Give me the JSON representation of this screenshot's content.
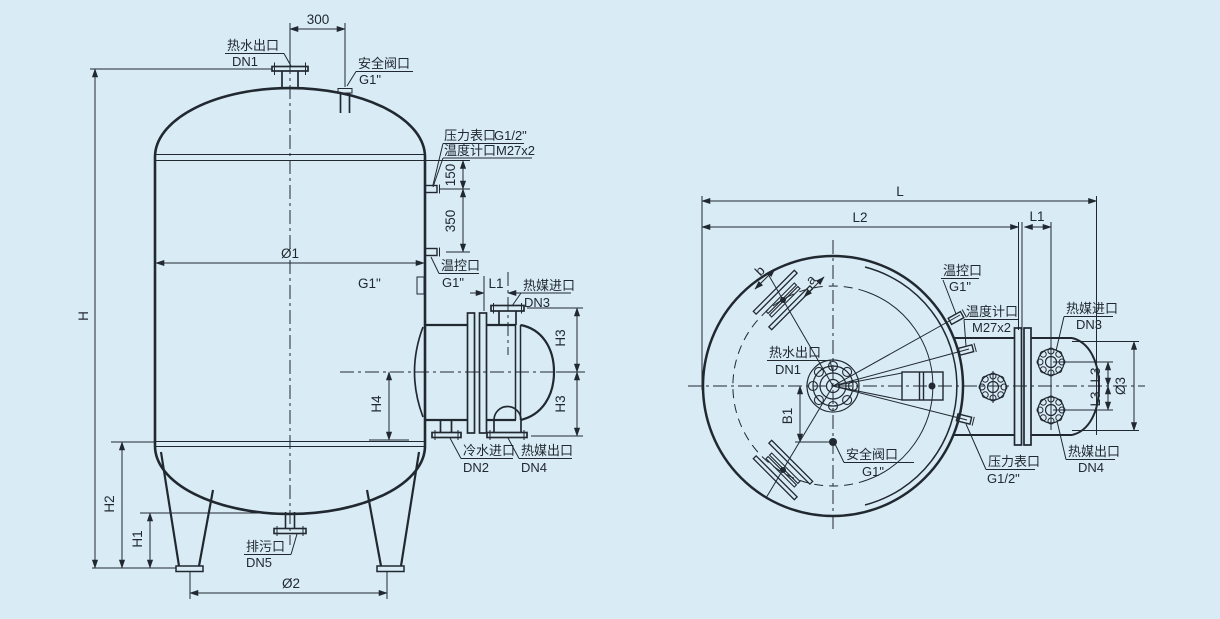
{
  "drawing_type": "pressure-vessel-engineering-drawing",
  "colors": {
    "background": "#d9ecf6",
    "line": "#212830"
  },
  "front": {
    "d300": "300",
    "d150": "150",
    "d350": "350",
    "hot_water": "热水出口",
    "hot_water_size": "DN1",
    "safety": "安全阀口",
    "safety_size": "G1\"",
    "pressure": "压力表口",
    "pressure_size": "G1/2\"",
    "thermo": "温度计口",
    "thermo_size": "M27x2",
    "tempctl": "温控口",
    "tempctl_size": "G1\"",
    "dia1": "Ø1",
    "coupling": "G1\"",
    "L1": "L1",
    "hm_in": "热媒进口",
    "hm_in_size": "DN3",
    "H3a": "H3",
    "H3b": "H3",
    "H4": "H4",
    "cw_in": "冷水进口",
    "cw_in_size": "DN2",
    "hm_out": "热媒出口",
    "hm_out_size": "DN4",
    "H": "H",
    "H2": "H2",
    "H1": "H1",
    "drain": "排污口",
    "drain_size": "DN5",
    "dia2": "Ø2"
  },
  "top": {
    "L": "L",
    "L2": "L2",
    "L1": "L1",
    "tempctl": "温控口",
    "tempctl_size": "G1\"",
    "thermo": "温度计口",
    "thermo_size": "M27x2",
    "hot_water": "热水出口",
    "hot_water_size": "DN1",
    "b": "b",
    "a": "a",
    "B1": "B1",
    "safety": "安全阀口",
    "safety_size": "G1\"",
    "pressure": "压力表口",
    "pressure_size": "G1/2\"",
    "hm_in": "热媒进口",
    "hm_in_size": "DN3",
    "hm_out": "热媒出口",
    "hm_out_size": "DN4",
    "L3a": "L3",
    "L3b": "L3",
    "dia3": "Ø3"
  }
}
